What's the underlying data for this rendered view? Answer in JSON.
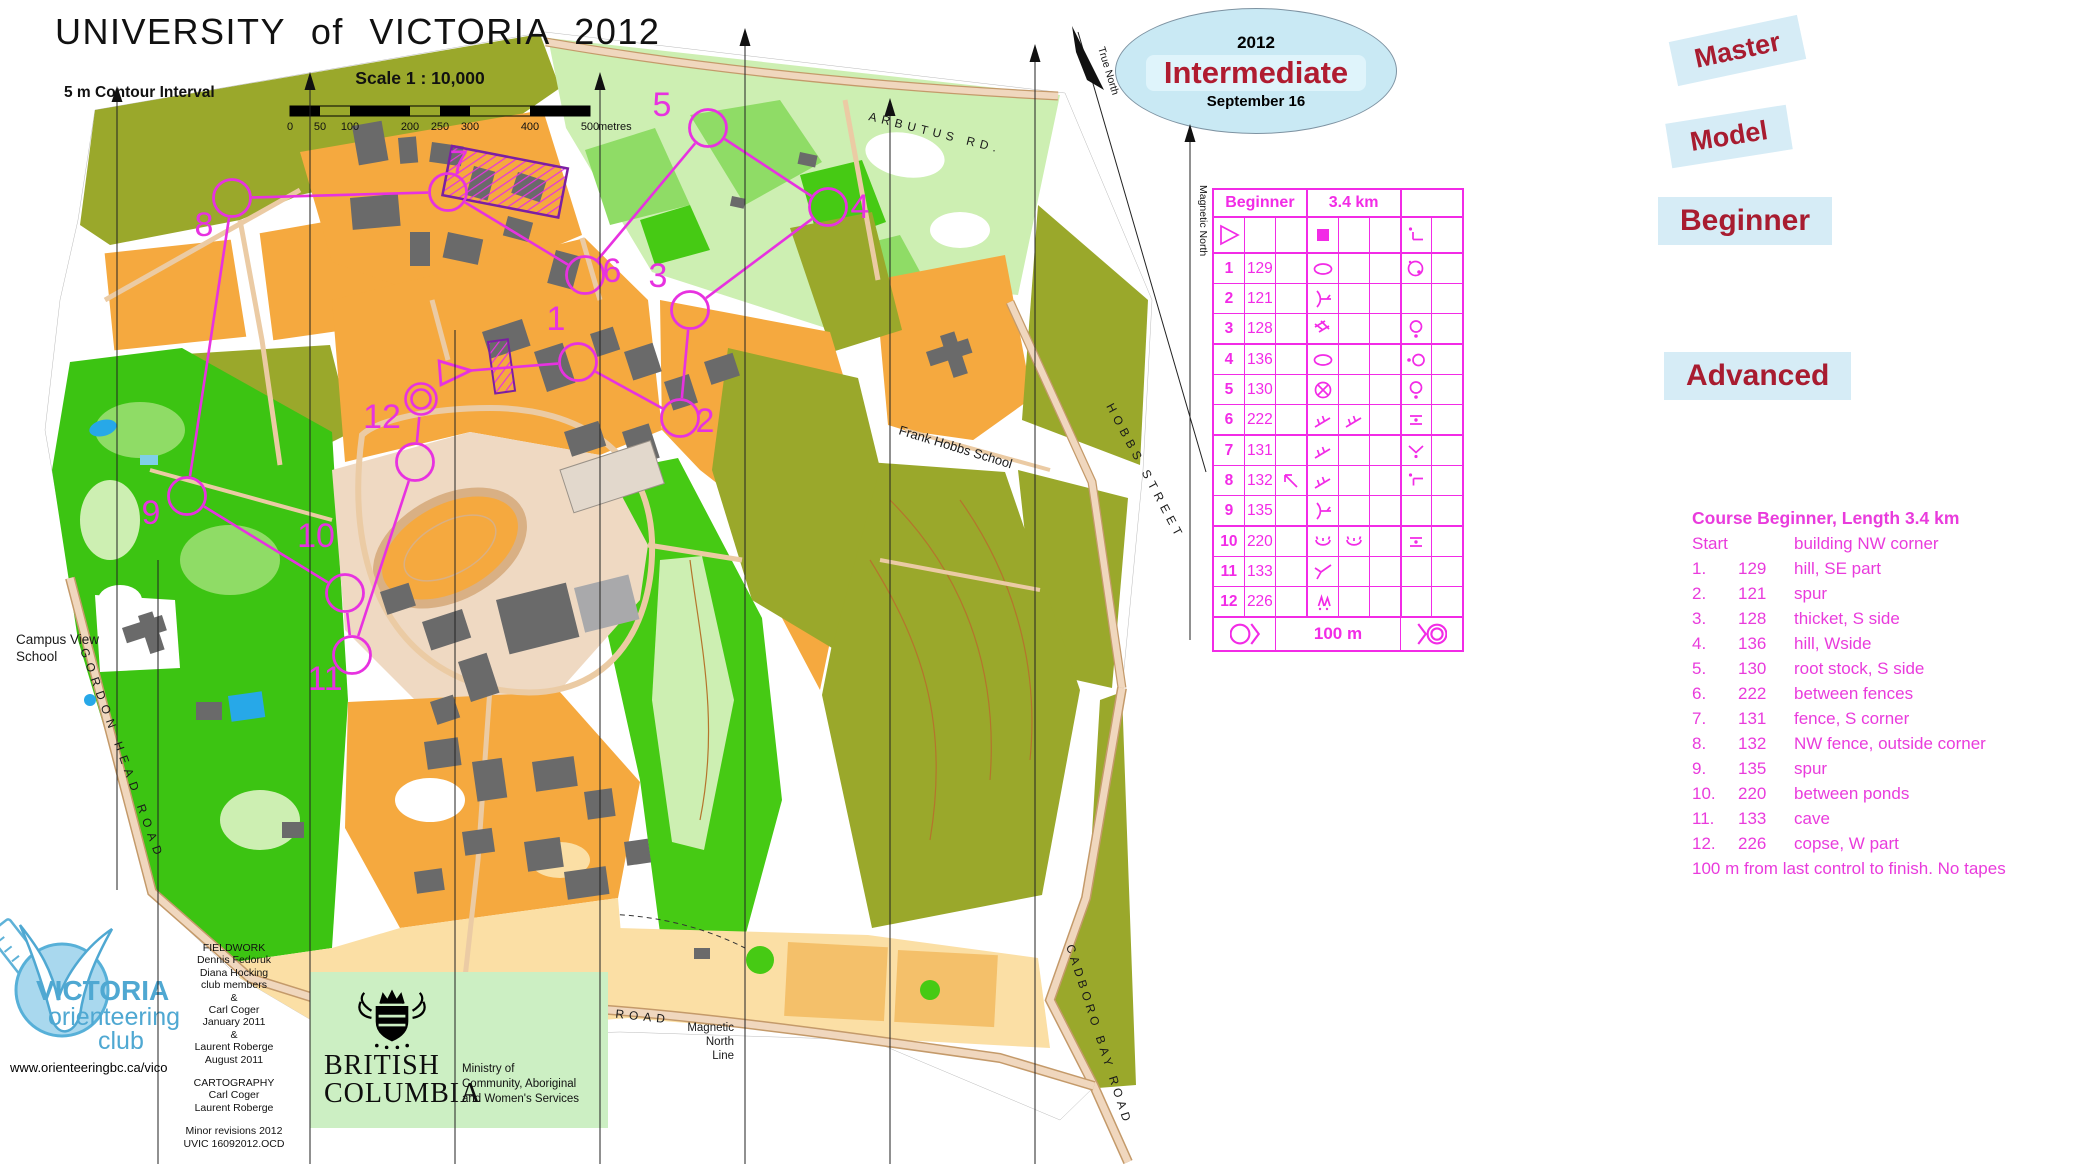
{
  "title": "UNIVERSITY  of  VICTORIA   2012",
  "map_info": {
    "contour_interval": "5 m Contour Interval",
    "scale_label": "Scale   1 : 10,000",
    "scale_ticks": [
      "0",
      "50",
      "100",
      "200",
      "250",
      "300",
      "400",
      "500"
    ],
    "scale_unit": "metres"
  },
  "badge": {
    "year": "2012",
    "title": "Intermediate",
    "date": "September 16"
  },
  "course_labels": {
    "master": "Master",
    "model": "Model",
    "beginner": "Beginner",
    "advanced": "Advanced"
  },
  "control_card": {
    "course": "Beginner",
    "length": "3.4 km",
    "footer": "100 m",
    "start_row": {
      "a": "start",
      "d": "square",
      "g": "bend"
    },
    "rows": [
      {
        "n": "1",
        "code": "129",
        "d": "hill",
        "g": "part-se"
      },
      {
        "n": "2",
        "code": "121",
        "d": "spur"
      },
      {
        "n": "3",
        "code": "128",
        "d": "thicket",
        "g": "side-s"
      },
      {
        "n": "4",
        "code": "136",
        "d": "hill",
        "g": "side-w"
      },
      {
        "n": "5",
        "code": "130",
        "d": "rootstock",
        "g": "side-s"
      },
      {
        "n": "6",
        "code": "222",
        "d": "fence",
        "e": "fence",
        "g": "between"
      },
      {
        "n": "7",
        "code": "131",
        "d": "fence",
        "g": "corner"
      },
      {
        "n": "8",
        "code": "132",
        "c": "arrow-nw",
        "d": "fence",
        "g": "outside-corner"
      },
      {
        "n": "9",
        "code": "135",
        "d": "spur"
      },
      {
        "n": "10",
        "code": "220",
        "d": "pond",
        "e": "pond",
        "g": "between"
      },
      {
        "n": "11",
        "code": "133",
        "d": "cave"
      },
      {
        "n": "12",
        "code": "226",
        "d": "copse",
        "g": "part-w"
      }
    ]
  },
  "course_description": {
    "title": "Course Beginner,  Length 3.4 km",
    "rows": [
      {
        "a": "Start",
        "b": "",
        "c": "building NW corner"
      },
      {
        "a": "1.",
        "b": "129",
        "c": "hill, SE part"
      },
      {
        "a": "2.",
        "b": "121",
        "c": "spur"
      },
      {
        "a": "3.",
        "b": "128",
        "c": "thicket, S side"
      },
      {
        "a": "4.",
        "b": "136",
        "c": "hill, Wside"
      },
      {
        "a": "5.",
        "b": "130",
        "c": "root stock, S side"
      },
      {
        "a": "6.",
        "b": "222",
        "c": "between fences"
      },
      {
        "a": "7.",
        "b": "131",
        "c": "fence, S corner"
      },
      {
        "a": "8.",
        "b": "132",
        "c": "NW fence, outside corner"
      },
      {
        "a": "9.",
        "b": "135",
        "c": "spur"
      },
      {
        "a": "10.",
        "b": "220",
        "c": "between ponds"
      },
      {
        "a": "11.",
        "b": "133",
        "c": "cave"
      },
      {
        "a": "12.",
        "b": "226",
        "c": "copse, W part"
      }
    ],
    "footer": "100 m from last control to finish. No tapes"
  },
  "map_labels": {
    "arbutus": "ARBUTUS RD.",
    "hobbs": "HOBBS STREET",
    "cadboro": "CADBORO BAY ROAD",
    "gordon": "GORDON HEAD ROAD",
    "cedar": "CEDAR HILL X ROAD",
    "frank": "Frank Hobbs School",
    "campus_view_1": "Campus View",
    "campus_view_2": "School",
    "magnetic_north": "Magnetic North",
    "true_north": "True North",
    "mag_line_1": "Magnetic",
    "mag_line_2": "North",
    "mag_line_3": "Line"
  },
  "course_overlay": {
    "color": "#E732E0",
    "start": {
      "x": 452,
      "y": 372
    },
    "finish": {
      "x": 421,
      "y": 399
    },
    "controls": [
      {
        "n": "1",
        "x": 578,
        "y": 362,
        "lx": 556,
        "ly": 330
      },
      {
        "n": "2",
        "x": 680,
        "y": 418,
        "lx": 705,
        "ly": 432
      },
      {
        "n": "3",
        "x": 690,
        "y": 310,
        "lx": 658,
        "ly": 287
      },
      {
        "n": "4",
        "x": 828,
        "y": 207,
        "lx": 860,
        "ly": 218
      },
      {
        "n": "5",
        "x": 708,
        "y": 128,
        "lx": 662,
        "ly": 116
      },
      {
        "n": "6",
        "x": 585,
        "y": 275,
        "lx": 612,
        "ly": 282
      },
      {
        "n": "7",
        "x": 448,
        "y": 192,
        "lx": 459,
        "ly": 174
      },
      {
        "n": "8",
        "x": 232,
        "y": 198,
        "lx": 204,
        "ly": 236
      },
      {
        "n": "9",
        "x": 187,
        "y": 496,
        "lx": 151,
        "ly": 524
      },
      {
        "n": "10",
        "x": 345,
        "y": 593,
        "lx": 316,
        "ly": 547
      },
      {
        "n": "11",
        "x": 352,
        "y": 655,
        "lx": 325,
        "ly": 690
      },
      {
        "n": "12",
        "x": 415,
        "y": 462,
        "lx": 382,
        "ly": 428
      }
    ]
  },
  "credits": {
    "lines": [
      "FIELDWORK",
      "Dennis Fedoruk",
      "Diana Hocking",
      "club members",
      "&",
      "Carl Coger",
      "January 2011",
      "&",
      "Laurent Roberge",
      "August 2011",
      "",
      "CARTOGRAPHY",
      "Carl Coger",
      "Laurent Roberge",
      "",
      "Minor revisions  2012",
      "UVIC 16092012.OCD"
    ]
  },
  "club": {
    "line1": "VICTORIA",
    "line2": "orienteering",
    "line3": "club",
    "url": "www.orienteeringbc.ca/vico"
  },
  "bc_logo": {
    "name1": "BRITISH",
    "name2": "COLUMBIA",
    "ministry1": "Ministry of",
    "ministry2": "Community, Aboriginal",
    "ministry3": "and Women's Services"
  },
  "colors": {
    "card_magenta": "#F22BE6",
    "course_magenta": "#E732E0",
    "desc_magenta": "#E93BDC",
    "badge_bg": "#C9E9F4",
    "label_bg": "#D6ECF6",
    "dark_red": "#A81C30",
    "olive": "#9AA82B",
    "orange_open": "#F5A93F",
    "bright_green": "#3CC412",
    "pale_green": "#CDEFB2",
    "sand": "#FBDFA5",
    "road_tan": "#EBCBA4",
    "building_gray": "#6A6A6A",
    "water_blue": "#27A8E8",
    "bc_green": "#CCEFC3",
    "logo_blue": "#57B0D8"
  }
}
